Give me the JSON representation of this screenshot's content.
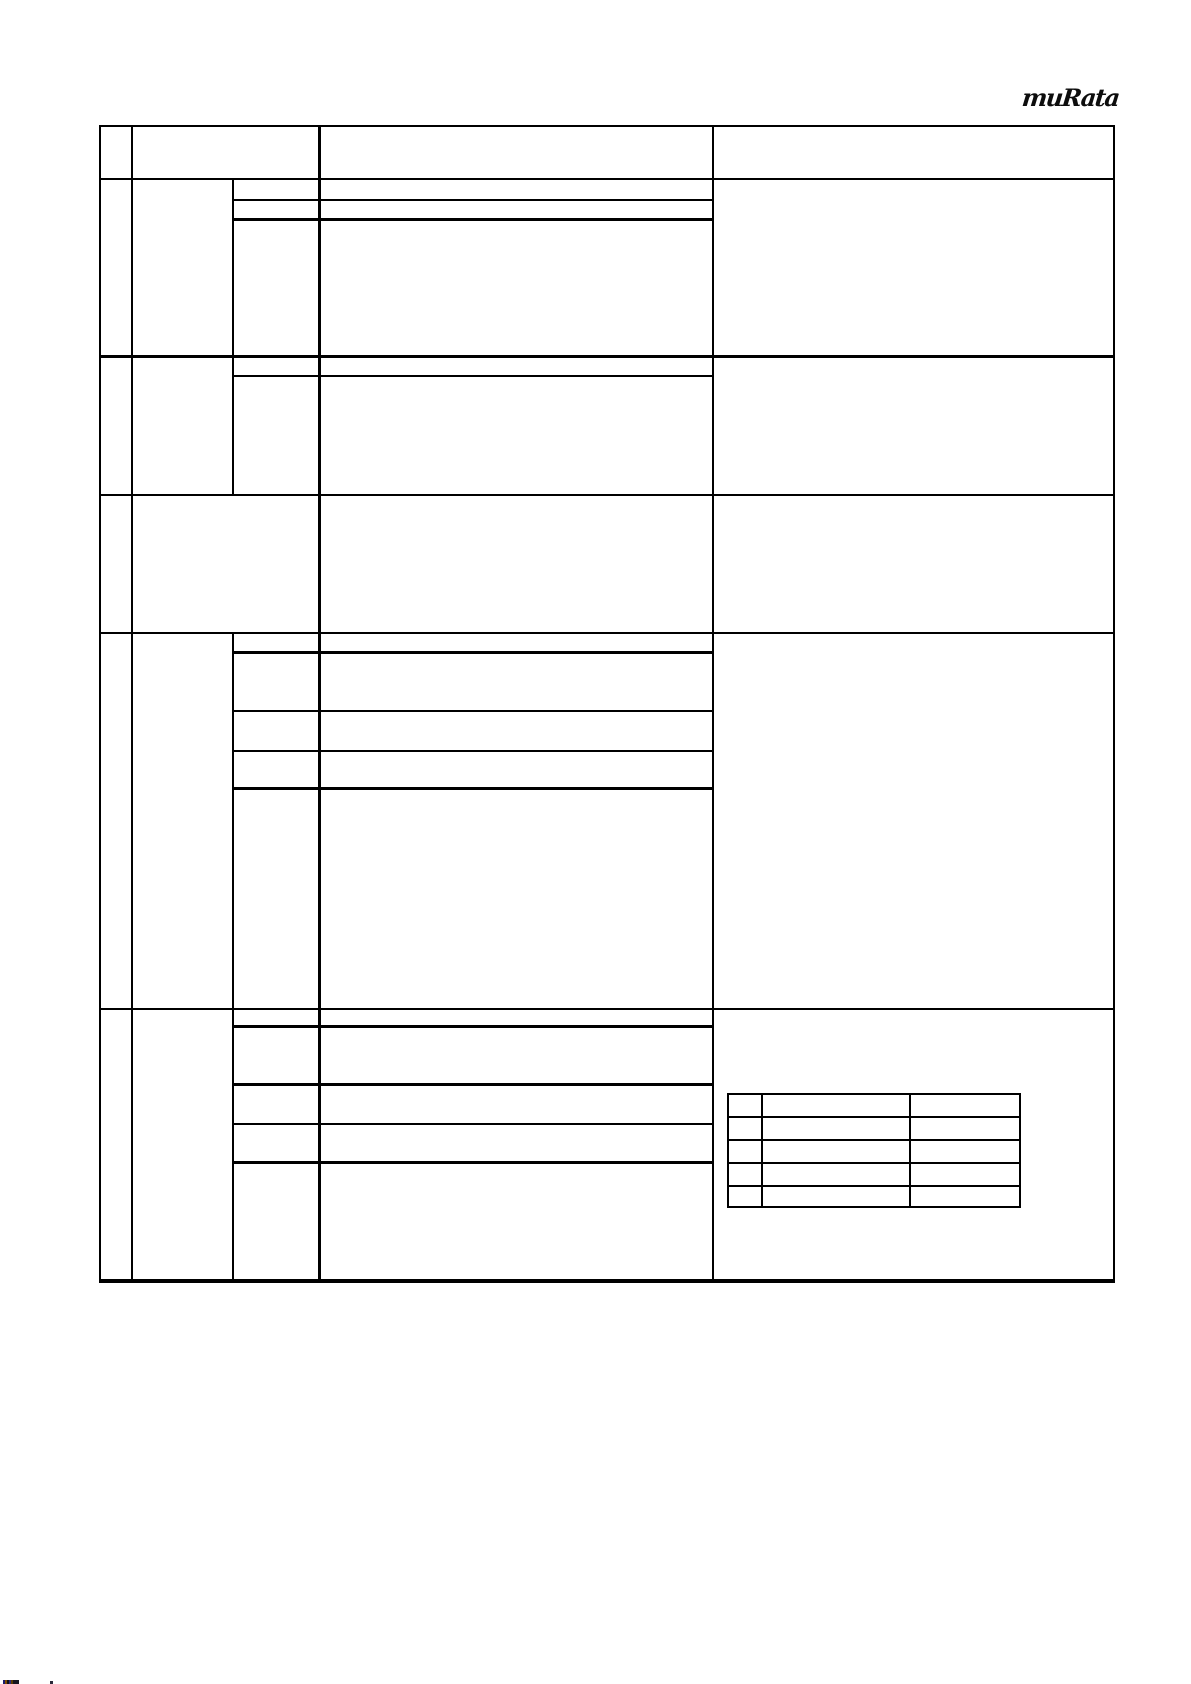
{
  "page": {
    "background": "#ffffff",
    "line_color": "#000000"
  },
  "logo": {
    "text": "muRata",
    "color": "#0d0d0d"
  },
  "spec_table": {
    "description_visible_text": "",
    "header_cells": [
      "",
      "",
      "",
      ""
    ],
    "row_group_count": 5,
    "columns_visible": 5,
    "cells": [
      [
        "",
        "",
        "",
        "",
        ""
      ],
      [
        "",
        "",
        "",
        "",
        ""
      ],
      [
        "",
        "",
        "",
        "",
        ""
      ],
      [
        "",
        "",
        "",
        "",
        ""
      ],
      [
        "",
        "",
        "",
        "",
        ""
      ]
    ]
  },
  "notes_subtable": {
    "rows": 5,
    "columns": 3,
    "cells": [
      [
        "",
        "",
        ""
      ],
      [
        "",
        "",
        ""
      ],
      [
        "",
        "",
        ""
      ],
      [
        "",
        "",
        ""
      ],
      [
        "",
        "",
        ""
      ]
    ]
  }
}
